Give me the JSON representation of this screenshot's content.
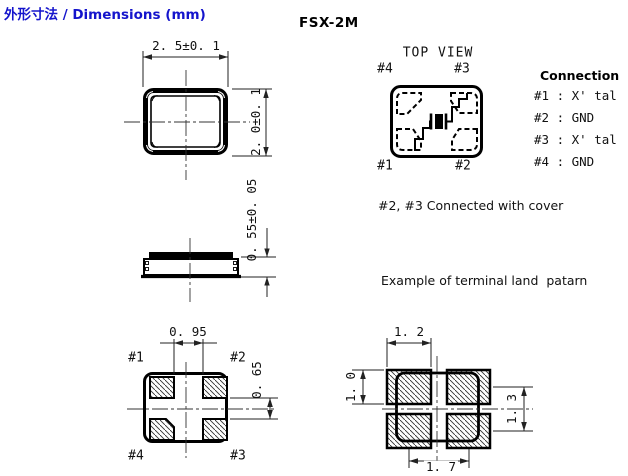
{
  "header": {
    "title": "外形寸法 / Dimensions (mm)",
    "model": "FSX-2M"
  },
  "colors": {
    "title_blue": "#1414cc",
    "ink": "#000000"
  },
  "outline_drawing": {
    "width_dim": "2. 5±0. 1",
    "height_dim": "2. 0±0. 1"
  },
  "side_drawing": {
    "thickness_dim": "0. 55±0. 05"
  },
  "top_view": {
    "title": "TOP VIEW",
    "pin_top_left": "#4",
    "pin_top_right": "#3",
    "pin_bottom_left": "#1",
    "pin_bottom_right": "#2"
  },
  "connection": {
    "heading": "Connection",
    "rows": [
      "#1 : X' tal",
      "#2 : GND",
      "#3 : X' tal",
      "#4 : GND"
    ]
  },
  "notes": {
    "cover": "#2, #3 Connected with cover",
    "land_example": "Example of terminal land  patarn"
  },
  "bottom_view": {
    "pin_top_left": "#1",
    "pin_top_right": "#2",
    "pin_bottom_left": "#4",
    "pin_bottom_right": "#3",
    "pad_gap_h_dim": "0. 95",
    "pad_gap_v_dim": "0. 65"
  },
  "land_pattern": {
    "pad_width_dim": "1. 2",
    "pad_height_dim": "1. 0",
    "pitch_v_dim": "1. 3",
    "pitch_h_dim": "1. 7"
  }
}
